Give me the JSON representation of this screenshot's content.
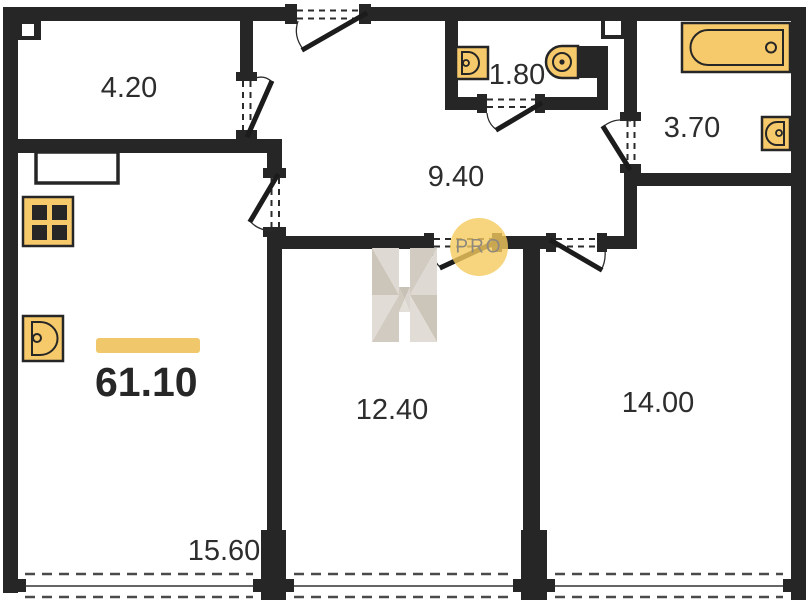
{
  "plan": {
    "title": "apartment-floor-plan",
    "total_area": "61.10",
    "rooms": [
      {
        "id": "room-top-left",
        "area": "4.20"
      },
      {
        "id": "wc",
        "area": "1.80"
      },
      {
        "id": "hallway",
        "area": "9.40"
      },
      {
        "id": "bathroom",
        "area": "3.70"
      },
      {
        "id": "bedroom-middle",
        "area": "12.40"
      },
      {
        "id": "bedroom-right",
        "area": "14.00"
      },
      {
        "id": "kitchen-living",
        "area": "15.60"
      }
    ],
    "watermark": {
      "letter": "H",
      "badge": "PRO"
    },
    "colors": {
      "wall": "#262626",
      "fixture": "#F6C96B",
      "accent_bar": "#F0C76A",
      "watermark_circle": "#F5CB5E"
    },
    "fixtures": [
      "bathtub",
      "toilet",
      "wc-sink",
      "bath-sink",
      "kitchen-sink",
      "stove",
      "counter"
    ]
  }
}
